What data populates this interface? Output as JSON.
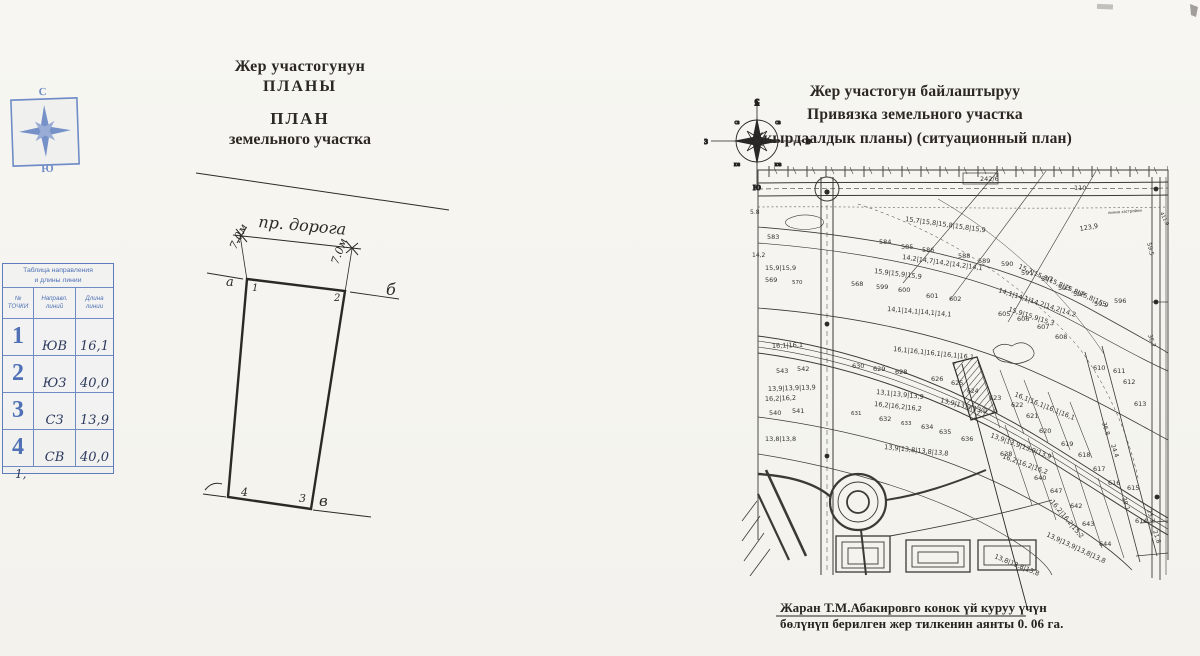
{
  "palette": {
    "paper": "#f6f5f1",
    "ink": "#26241f",
    "stamp_blue": "#5071b6",
    "pen_blue": "#2e3a5e"
  },
  "left_page": {
    "compass_stamp": {
      "north": "С",
      "south": "Ю"
    },
    "title_lines": [
      "Жер участогунун",
      "ПЛАНЫ",
      "ПЛАН",
      "земельного участка"
    ],
    "table": {
      "title_lines": [
        "Таблица направления",
        "и длины линии"
      ],
      "col_headers": [
        [
          "№",
          "ТОЧКИ"
        ],
        [
          "Направл.",
          "линий"
        ],
        [
          "Длина",
          "линии"
        ]
      ],
      "rows": [
        {
          "n": "1",
          "dir": "ЮВ",
          "len": "16,1"
        },
        {
          "n": "2",
          "dir": "ЮЗ",
          "len": "40,0"
        },
        {
          "n": "3",
          "dir": "СЗ",
          "len": "13,9"
        },
        {
          "n": "4",
          "dir": "СВ",
          "len": "40,0"
        }
      ],
      "footnote": "1,"
    },
    "drawing_labels": [
      {
        "t": "пр. дорога",
        "x": 258,
        "y": 227,
        "r": 5,
        "s": 16
      },
      {
        "t": "7.0м",
        "x": 236,
        "y": 250,
        "r": -64,
        "s": 11
      },
      {
        "t": "7.0м",
        "x": 338,
        "y": 265,
        "r": -70,
        "s": 11
      },
      {
        "t": "1",
        "x": 252,
        "y": 291,
        "s": 10
      },
      {
        "t": "2",
        "x": 334,
        "y": 301,
        "s": 10
      },
      {
        "t": "3",
        "x": 299,
        "y": 502,
        "s": 11
      },
      {
        "t": "4",
        "x": 241,
        "y": 496,
        "s": 11
      },
      {
        "t": "а",
        "x": 226,
        "y": 286,
        "s": 13
      },
      {
        "t": "б",
        "x": 386,
        "y": 295,
        "s": 16
      },
      {
        "t": "в",
        "x": 319,
        "y": 506,
        "s": 15
      }
    ]
  },
  "right_page": {
    "title_lines": [
      "Жер участогун байлаштыруу",
      "Привязка земельного участка",
      "(кырдаалдык планы) (ситуационный план)"
    ],
    "compass": {
      "n": "С",
      "s": "Ю",
      "w": "З",
      "e": "В",
      "nw": "СЗ",
      "ne": "СВ",
      "sw": "ЮЗ",
      "se": "ЮВ"
    },
    "caption_lines": [
      "Жаран  Т.М.Абакировго   конок үй куруу үчүн",
      "бөлүнүп берилген жер тилкенин аянты   0. 06 га."
    ],
    "map_labels": [
      {
        "t": "242/6",
        "x": 980,
        "y": 181,
        "s": 6.5
      },
      {
        "t": "110",
        "x": 1074,
        "y": 190,
        "s": 6.5
      },
      {
        "t": "линия застройки",
        "x": 1108,
        "y": 214,
        "s": 3.8,
        "r": -4
      },
      {
        "t": "123,9",
        "x": 1080,
        "y": 231,
        "s": 6.5,
        "r": -10
      },
      {
        "t": "59.5",
        "x": 1147,
        "y": 243,
        "s": 6,
        "r": 76
      },
      {
        "t": "411.9",
        "x": 1160,
        "y": 213,
        "s": 5,
        "r": 64
      },
      {
        "t": "5.8",
        "x": 750,
        "y": 214,
        "s": 6
      },
      {
        "t": "583",
        "x": 767,
        "y": 239
      },
      {
        "t": "15,7|15,8|15,8|15,8|15,9",
        "x": 905,
        "y": 221,
        "r": 8
      },
      {
        "t": "584",
        "x": 879,
        "y": 244
      },
      {
        "t": "585",
        "x": 901,
        "y": 249
      },
      {
        "t": "586",
        "x": 922,
        "y": 252
      },
      {
        "t": "588",
        "x": 958,
        "y": 258
      },
      {
        "t": "14,2|14,7|14,2|14,2|14,1",
        "x": 902,
        "y": 259,
        "r": 8
      },
      {
        "t": "14,2",
        "x": 752,
        "y": 257,
        "s": 6
      },
      {
        "t": "15,9|15,9",
        "x": 765,
        "y": 270
      },
      {
        "t": "15,9|15,9|15,9",
        "x": 874,
        "y": 273,
        "r": 7
      },
      {
        "t": "569",
        "x": 765,
        "y": 282
      },
      {
        "t": "570",
        "x": 792,
        "y": 284,
        "s": 5.5
      },
      {
        "t": "568",
        "x": 851,
        "y": 286
      },
      {
        "t": "599",
        "x": 876,
        "y": 289
      },
      {
        "t": "600",
        "x": 898,
        "y": 292
      },
      {
        "t": "601",
        "x": 926,
        "y": 298
      },
      {
        "t": "602",
        "x": 949,
        "y": 301
      },
      {
        "t": "589",
        "x": 978,
        "y": 263
      },
      {
        "t": "590",
        "x": 1001,
        "y": 266
      },
      {
        "t": "591",
        "x": 1021,
        "y": 275
      },
      {
        "t": "592",
        "x": 1041,
        "y": 281
      },
      {
        "t": "593",
        "x": 1058,
        "y": 290
      },
      {
        "t": "594",
        "x": 1073,
        "y": 296
      },
      {
        "t": "595",
        "x": 1094,
        "y": 306
      },
      {
        "t": "596",
        "x": 1114,
        "y": 303
      },
      {
        "t": "15,7|15,8|15,8|15,8|15,8|15,9",
        "x": 1018,
        "y": 268,
        "r": 24
      },
      {
        "t": "14,1|14,1|14,2|14,2|14,2",
        "x": 998,
        "y": 292,
        "r": 18
      },
      {
        "t": "14,1|14,1|14,1|14,1",
        "x": 887,
        "y": 311,
        "r": 5
      },
      {
        "t": "15,9|15,9|15,3",
        "x": 1008,
        "y": 311,
        "r": 18
      },
      {
        "t": "16,1|16,1",
        "x": 772,
        "y": 348,
        "r": -2
      },
      {
        "t": "16,1|16,1|16,1|16,1|16,1",
        "x": 893,
        "y": 351,
        "r": 6
      },
      {
        "t": "543",
        "x": 776,
        "y": 373
      },
      {
        "t": "542",
        "x": 797,
        "y": 371
      },
      {
        "t": "630",
        "x": 852,
        "y": 368
      },
      {
        "t": "629",
        "x": 873,
        "y": 371
      },
      {
        "t": "628",
        "x": 895,
        "y": 374
      },
      {
        "t": "626",
        "x": 931,
        "y": 381
      },
      {
        "t": "625",
        "x": 951,
        "y": 385
      },
      {
        "t": "605",
        "x": 998,
        "y": 316
      },
      {
        "t": "606",
        "x": 1017,
        "y": 321
      },
      {
        "t": "607",
        "x": 1037,
        "y": 329
      },
      {
        "t": "608",
        "x": 1055,
        "y": 339
      },
      {
        "t": "610",
        "x": 1093,
        "y": 370
      },
      {
        "t": "611",
        "x": 1113,
        "y": 373
      },
      {
        "t": "612",
        "x": 1123,
        "y": 384
      },
      {
        "t": "613",
        "x": 1134,
        "y": 406
      },
      {
        "t": "13,9|13,9|13,9",
        "x": 768,
        "y": 391,
        "r": -2
      },
      {
        "t": "13,1|13,9|13,9",
        "x": 876,
        "y": 394,
        "r": 6
      },
      {
        "t": "13,9|13,9|13,9",
        "x": 940,
        "y": 402,
        "r": 14
      },
      {
        "t": "16,2|16,2",
        "x": 765,
        "y": 401,
        "r": -2
      },
      {
        "t": "16,2|16,2|16,2",
        "x": 874,
        "y": 406,
        "r": 6
      },
      {
        "t": "540",
        "x": 769,
        "y": 415
      },
      {
        "t": "541",
        "x": 792,
        "y": 413
      },
      {
        "t": "631",
        "x": 851,
        "y": 415,
        "s": 5.5
      },
      {
        "t": "632",
        "x": 879,
        "y": 421
      },
      {
        "t": "633",
        "x": 901,
        "y": 425,
        "s": 5.5
      },
      {
        "t": "634",
        "x": 921,
        "y": 429
      },
      {
        "t": "635",
        "x": 939,
        "y": 434
      },
      {
        "t": "636",
        "x": 961,
        "y": 441
      },
      {
        "t": "16,1|16,1|16,1|16,1",
        "x": 1014,
        "y": 396,
        "r": 22
      },
      {
        "t": "624",
        "x": 967,
        "y": 393,
        "s": 6
      },
      {
        "t": "623",
        "x": 989,
        "y": 400
      },
      {
        "t": "622",
        "x": 1011,
        "y": 407
      },
      {
        "t": "621",
        "x": 1026,
        "y": 418
      },
      {
        "t": "620",
        "x": 1039,
        "y": 433
      },
      {
        "t": "619",
        "x": 1061,
        "y": 446
      },
      {
        "t": "618",
        "x": 1078,
        "y": 457
      },
      {
        "t": "617",
        "x": 1093,
        "y": 471
      },
      {
        "t": "616",
        "x": 1108,
        "y": 485
      },
      {
        "t": "615",
        "x": 1127,
        "y": 490
      },
      {
        "t": "614",
        "x": 1135,
        "y": 523
      },
      {
        "t": "13,9|13,9|13,9|13,9",
        "x": 990,
        "y": 437,
        "r": 20
      },
      {
        "t": "16,2|16,2|16,2",
        "x": 1002,
        "y": 458,
        "r": 20
      },
      {
        "t": "36.8",
        "x": 1102,
        "y": 423,
        "r": 72,
        "s": 6
      },
      {
        "t": "24.4",
        "x": 1111,
        "y": 445,
        "r": 72,
        "s": 6
      },
      {
        "t": "39.1",
        "x": 1122,
        "y": 498,
        "r": 72,
        "s": 6
      },
      {
        "t": "36.2",
        "x": 1148,
        "y": 335,
        "r": 72,
        "s": 6
      },
      {
        "t": "13,8|13,8",
        "x": 765,
        "y": 441
      },
      {
        "t": "13,9|13,8|13,8|13,8",
        "x": 884,
        "y": 449,
        "r": 6
      },
      {
        "t": "638",
        "x": 1000,
        "y": 456
      },
      {
        "t": "640",
        "x": 1034,
        "y": 480
      },
      {
        "t": "647",
        "x": 1050,
        "y": 493
      },
      {
        "t": "642",
        "x": 1070,
        "y": 508
      },
      {
        "t": "643",
        "x": 1082,
        "y": 526
      },
      {
        "t": "644",
        "x": 1099,
        "y": 546
      },
      {
        "t": "13,9|13,9|13,8|13,8",
        "x": 1046,
        "y": 536,
        "r": 25
      },
      {
        "t": "13,8|13,8|13,8",
        "x": 994,
        "y": 558,
        "r": 22
      },
      {
        "t": "16,2|16,2|15,2",
        "x": 1050,
        "y": 502,
        "r": 50
      },
      {
        "t": "21.8",
        "x": 1153,
        "y": 531,
        "r": 72,
        "s": 6
      },
      {
        "t": "25.3",
        "x": 1147,
        "y": 510,
        "r": 72,
        "s": 6
      }
    ]
  }
}
